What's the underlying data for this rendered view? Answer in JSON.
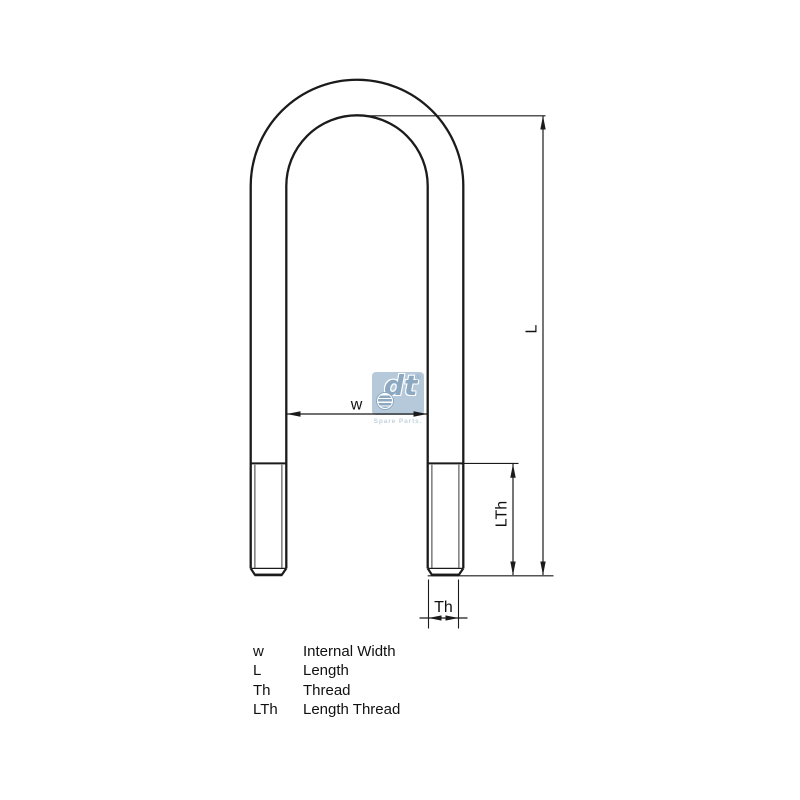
{
  "diagram": {
    "name": "u-bolt-technical-drawing",
    "dimension_labels": {
      "w": "w",
      "L": "L",
      "Th": "Th",
      "LTh": "LTh"
    }
  },
  "legend": {
    "rows": [
      {
        "abbr": "w",
        "desc": "Internal Width"
      },
      {
        "abbr": "L",
        "desc": "Length"
      },
      {
        "abbr": "Th",
        "desc": "Thread"
      },
      {
        "abbr": "LTh",
        "desc": "Length Thread"
      }
    ]
  },
  "logo": {
    "brand": "dt",
    "registered": "®",
    "tagline": "Spare Parts."
  },
  "colors": {
    "line": "#1b1b1b",
    "thread_line": "#3a3a3a",
    "logo_blue": "#8da9c2",
    "logo_bg": "#b5c9da",
    "logo_tagline": "#c2d2df"
  }
}
